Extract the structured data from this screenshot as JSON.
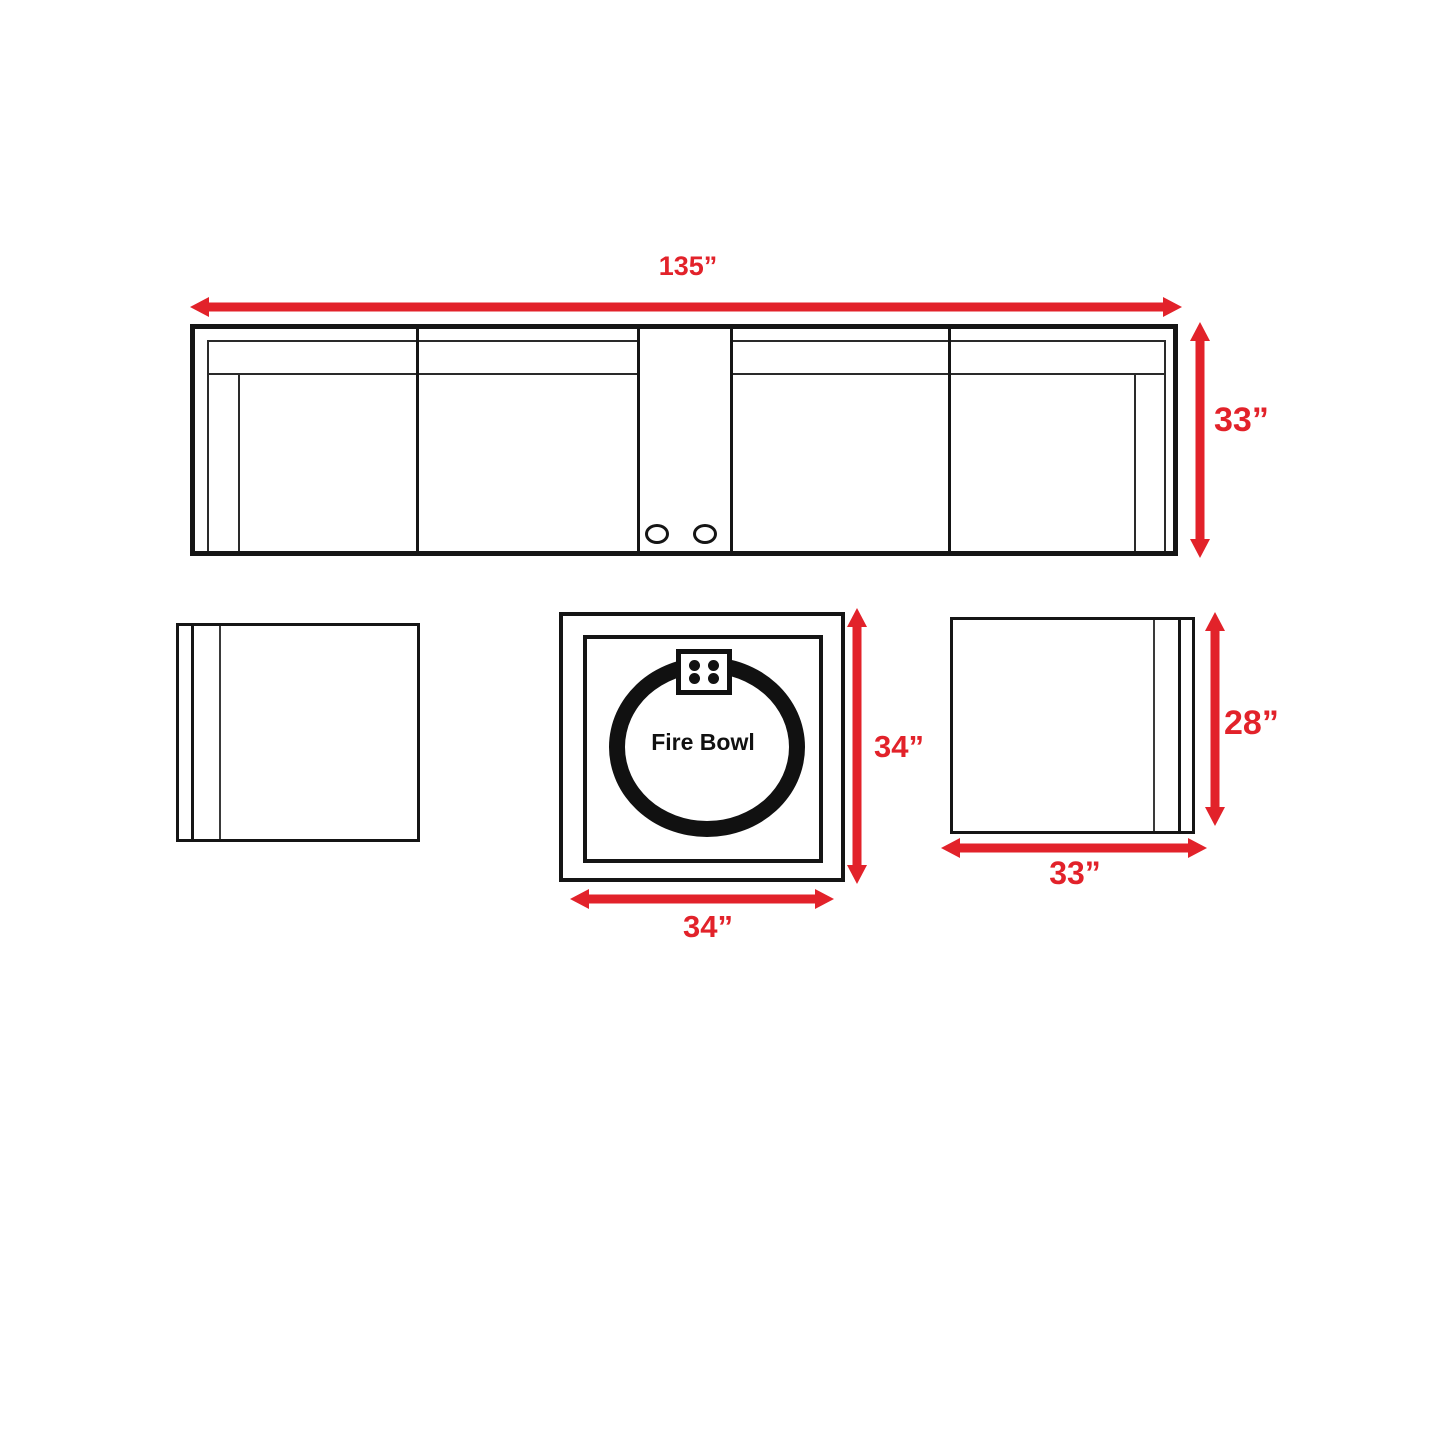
{
  "colors": {
    "dimension_red": "#e2222a",
    "line_black": "#151515"
  },
  "sofa": {
    "width_label": "135”",
    "depth_label": "33”"
  },
  "fire_table": {
    "center_label": "Fire Bowl",
    "width_label": "34”",
    "depth_label": "34”"
  },
  "right_table": {
    "width_label": "33”",
    "height_label": "28”"
  }
}
